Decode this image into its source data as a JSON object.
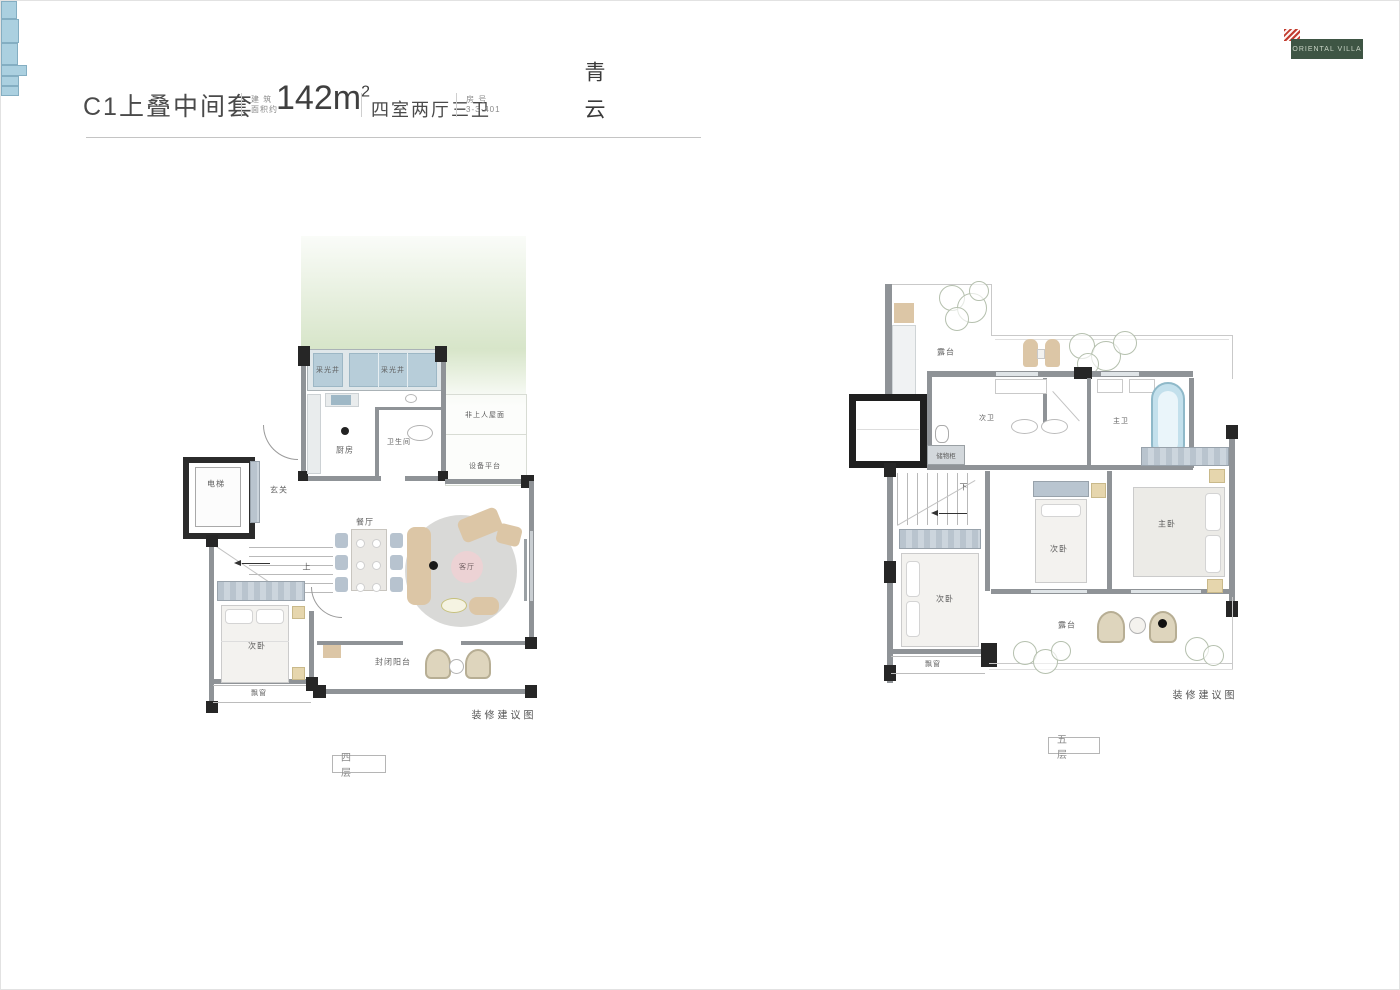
{
  "header": {
    "title": "C1上叠中间套",
    "area_label_top": "建 筑",
    "area_label_bottom": "面积约",
    "area_value": "142m",
    "area_sup": "2",
    "layout": "四室两厅三卫",
    "unit_label_top": "房  号",
    "unit_value": "3-3-401",
    "brand": "青云"
  },
  "logo": {
    "name": "ORIENTAL VILLA"
  },
  "floor4": {
    "floor_label": "四 层",
    "caption": "装修建议图",
    "rooms": {
      "light_well_a": "采光井",
      "light_well_b": "采光井",
      "kitchen": "厨房",
      "bathroom": "卫生间",
      "roof": "非上人屋面",
      "equipment_platform": "设备平台",
      "elevator": "电梯",
      "foyer": "玄关",
      "stair_up": "上",
      "dining": "餐厅",
      "living": "客厅",
      "bedroom": "次卧",
      "bay_window": "飘窗",
      "balcony": "封闭阳台"
    }
  },
  "floor5": {
    "floor_label": "五 层",
    "caption": "装修建议图",
    "rooms": {
      "terrace_top": "露台",
      "bath_second": "次卫",
      "bath_master": "主卫",
      "storage": "储物柜",
      "stair_down": "下",
      "bedroom_left": "次卧",
      "bedroom_middle": "次卧",
      "bedroom_master": "主卧",
      "terrace_bottom": "露台",
      "bay_window": "飘窗"
    }
  }
}
